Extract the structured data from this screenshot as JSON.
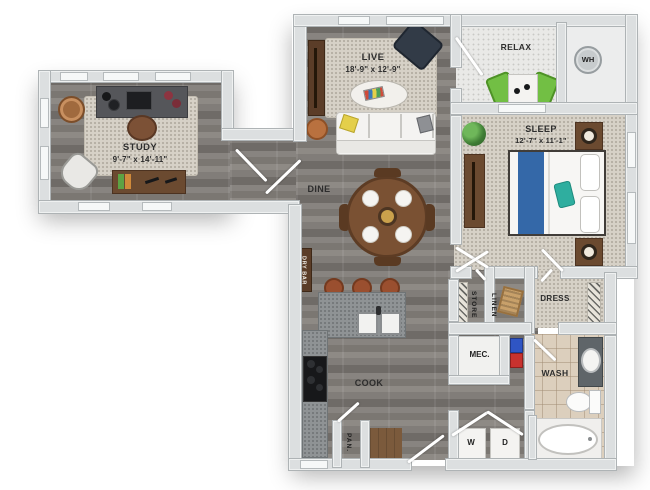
{
  "rooms": {
    "study": {
      "label": "STUDY",
      "dims": "9'-7\" x 14'-11\""
    },
    "live": {
      "label": "LIVE",
      "dims": "18'-9\" x 12'-9\""
    },
    "sleep": {
      "label": "SLEEP",
      "dims": "12'-7\" x 11'-1\""
    },
    "relax": {
      "label": "RELAX"
    },
    "dine": {
      "label": "DINE"
    },
    "cook": {
      "label": "COOK"
    },
    "wash": {
      "label": "WASH"
    },
    "dress": {
      "label": "DRESS"
    }
  },
  "closets": {
    "water_heater": "WH",
    "storage": "STORE",
    "linen": "LINEN",
    "mechanical": "MEC.",
    "pantry": "PAN.",
    "dry_bar": "DRY BAR",
    "washer": "W",
    "dryer": "D"
  },
  "palette": {
    "background": "#ffffff",
    "wall": "#dcdfe0",
    "wood_floor": "#827e79",
    "carpet": "#d6d1c7",
    "tile": "#dccfbd",
    "concrete": "#e9e9e7",
    "cabinet_wood": "#6b4a30",
    "counter_gray": "#8f9395",
    "accent_green": "#72bf44",
    "bed_blue": "#3468a8",
    "accent_teal": "#2fae9f",
    "accent_yellow": "#e4cf4a",
    "towel_red": "#c8322e",
    "towel_blue": "#2f55c4"
  }
}
